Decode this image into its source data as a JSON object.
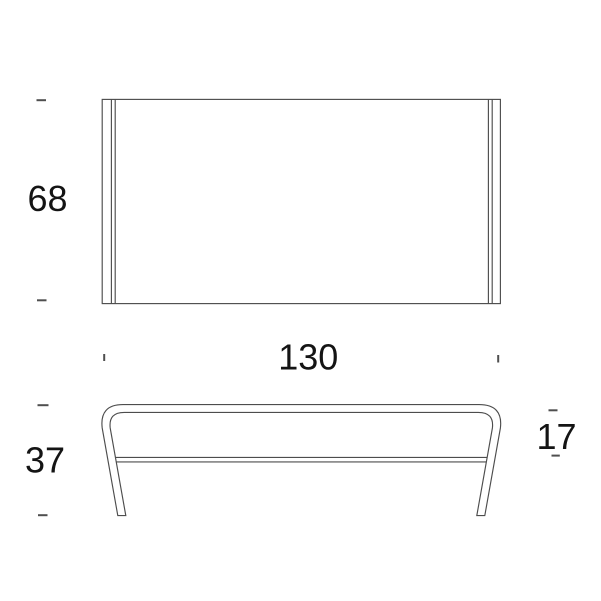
{
  "drawing": {
    "colors": {
      "line": "#4d4d4d",
      "tick": "#4f4f4f",
      "text": "#141414",
      "background": "#ffffff"
    },
    "dimensions": {
      "depth": "68",
      "width": "130",
      "height": "37",
      "side": "17"
    }
  }
}
